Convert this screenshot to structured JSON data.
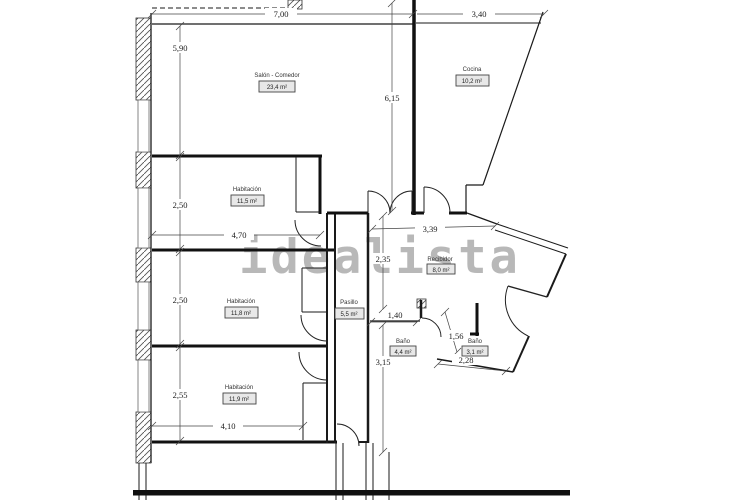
{
  "watermark": {
    "text": "idealista",
    "color": "#b3b3b3"
  },
  "plan": {
    "wall_color": "#1a1a1a",
    "rooms": {
      "salon": {
        "name": "Salón - Comedor",
        "area": "23,4 m²"
      },
      "cocina": {
        "name": "Cocina",
        "area": "10,2 m²"
      },
      "habitacion1": {
        "name": "Habitación",
        "area": "11,5 m²"
      },
      "habitacion2": {
        "name": "Habitación",
        "area": "11,8 m²"
      },
      "habitacion3": {
        "name": "Habitación",
        "area": "11,9 m²"
      },
      "pasillo": {
        "name": "Pasillo",
        "area": "5,5 m²"
      },
      "recibidor": {
        "name": "Recibidor",
        "area": "8,0 m²"
      },
      "banio1": {
        "name": "Baño",
        "area": "4,4 m²"
      },
      "banio2": {
        "name": "Baño",
        "area": "3,1 m²"
      }
    },
    "dimensions": {
      "top_width": "7,00",
      "kitchen_width": "3,40",
      "salon_height": "5,90",
      "salon_depth": "6,15",
      "bed1_height": "2,50",
      "bed1_width": "4,70",
      "bed2_height": "2,50",
      "bed3_height": "2,55",
      "bed3_width": "4,10",
      "hall_width": "3,39",
      "hall_depth": "2,35",
      "bath1_width": "1,40",
      "bath1_depth": "3,15",
      "bath2_diag": "1,56",
      "bath2_width": "2,28"
    }
  }
}
